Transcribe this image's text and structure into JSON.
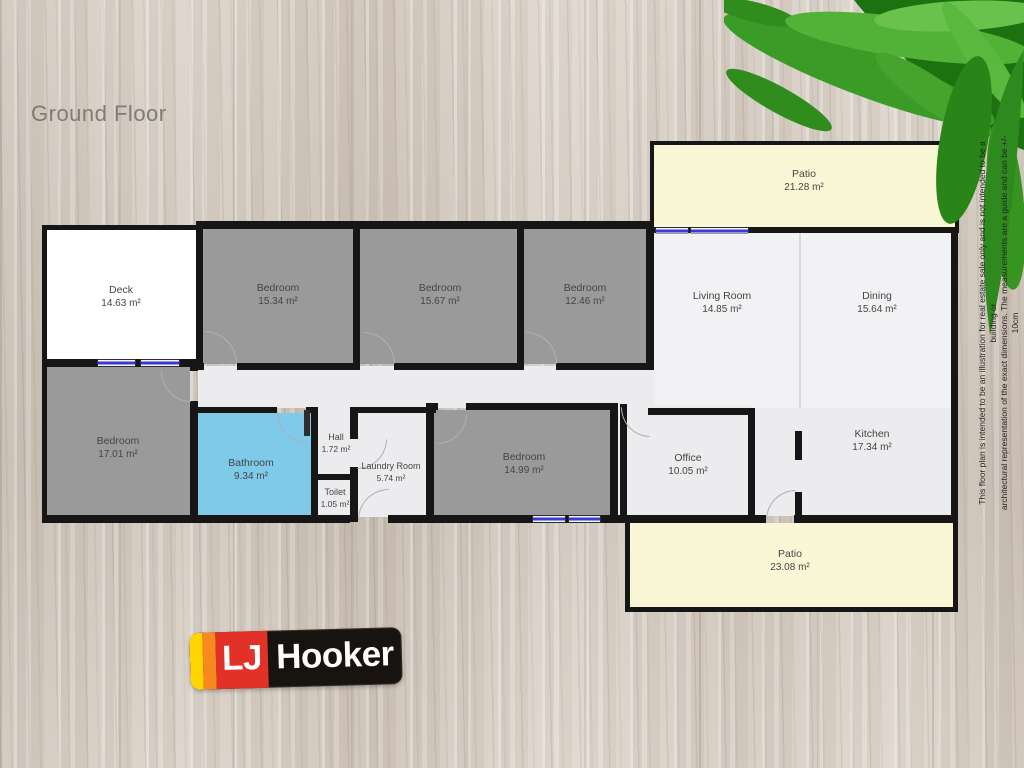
{
  "title": {
    "label": "Ground Floor"
  },
  "floorplan": {
    "rooms": [
      {
        "name": "Patio",
        "area": "21.28 m²"
      },
      {
        "name": "Deck",
        "area": "14.63 m²"
      },
      {
        "name": "Bedroom",
        "area": "15.34 m²"
      },
      {
        "name": "Bedroom",
        "area": "15.67 m²"
      },
      {
        "name": "Bedroom",
        "area": "12.46 m²"
      },
      {
        "name": "Living Room",
        "area": "14.85 m²"
      },
      {
        "name": "Dining",
        "area": "15.64 m²"
      },
      {
        "name": "Bedroom",
        "area": "17.01 m²"
      },
      {
        "name": "Bathroom",
        "area": "9.34 m²"
      },
      {
        "name": "Hall",
        "area": "1.72 m²"
      },
      {
        "name": "Toilet",
        "area": "1.05 m²"
      },
      {
        "name": "Laundry Room",
        "area": "5.74 m²"
      },
      {
        "name": "Bedroom",
        "area": "14.99 m²"
      },
      {
        "name": "Office",
        "area": "10.05 m²"
      },
      {
        "name": "Kitchen",
        "area": "17.34 m²"
      },
      {
        "name": "Patio",
        "area": "23.08 m²"
      }
    ],
    "colors": {
      "wall": "#161616",
      "bedroom_fill": "#9a9a9a",
      "bathroom_fill": "#7fc9e9",
      "patio_fill": "#f9f7d6",
      "light_fill": "#ececee",
      "living_fill": "#f2f2f4",
      "deck_fill": "#ffffff",
      "window_blue": "#3a3ad6"
    },
    "disclaimer": {
      "line1": "This floor plan is intended to be an illustration for real estate sale only and is not intended to be a building or",
      "line2": "architectural representation of the exact dimensions. The measurements are a guide and can be +/- 10cm"
    }
  },
  "logo": {
    "lj": "LJ",
    "name": "Hooker",
    "colors": {
      "yellow": "#ffd400",
      "orange": "#f6891f",
      "red": "#e23228",
      "black": "#17130f"
    }
  }
}
